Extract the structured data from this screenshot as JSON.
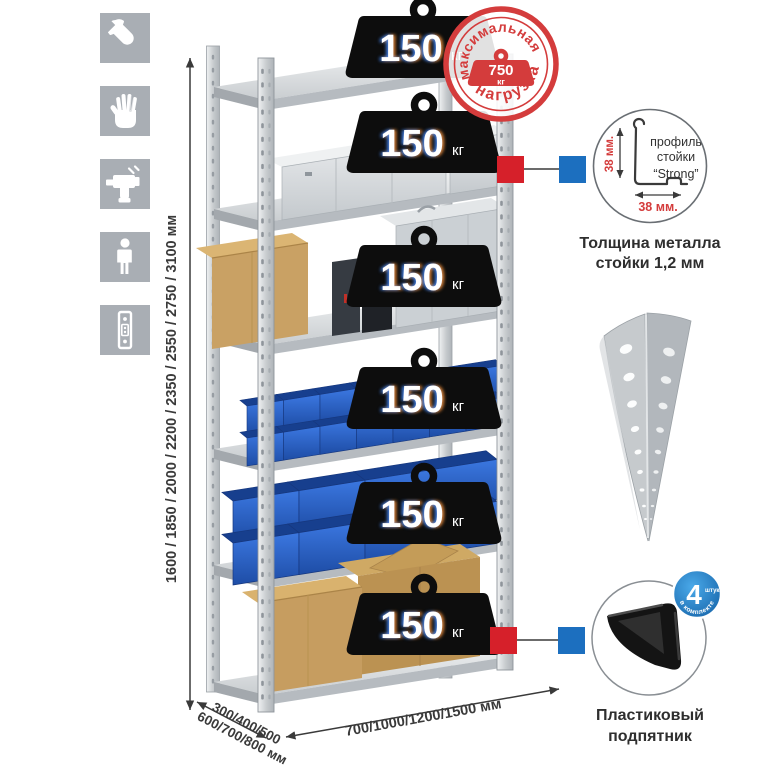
{
  "icons": [
    "wrench-icon",
    "gloves-icon",
    "drill-icon",
    "person-icon",
    "rack-post-icon"
  ],
  "max_load_stamp": {
    "text_top": "максимальная",
    "text_bottom": "нагрузка",
    "value": "750",
    "unit": "кг",
    "color": "#d43c3c"
  },
  "shelf_loads": [
    {
      "value": "150",
      "unit": "кг"
    },
    {
      "value": "150",
      "unit": "кг"
    },
    {
      "value": "150",
      "unit": "кг"
    },
    {
      "value": "150",
      "unit": "кг"
    },
    {
      "value": "150",
      "unit": "кг"
    },
    {
      "value": "150",
      "unit": "кг"
    }
  ],
  "dimensions": {
    "height": "1600 / 1850 / 2000 / 2200 / 2350 / 2550 / 2750 / 3100 мм",
    "depth_line1": "300/400/500",
    "depth_line2": "600/700/800 мм",
    "width": "700/1000/1200/1500 мм"
  },
  "profile_detail": {
    "line1": "профиль",
    "line2": "стойки",
    "line3": "“Strong”",
    "dim_vertical": "38 мм.",
    "dim_horizontal": "38 мм.",
    "caption1": "Толщина металла",
    "caption2": "стойки 1,2 мм"
  },
  "foot_detail": {
    "badge_value": "4",
    "badge_small": "штуки",
    "badge_arc": "в комплекте",
    "caption1": "Пластиковый",
    "caption2": "подпятник"
  },
  "colors": {
    "marker_red": "#d6202a",
    "marker_blue": "#1c6fbf",
    "bin_blue": "#2c64cf",
    "icon_gray": "#a9aeb4",
    "metal": "#d5d8db"
  }
}
